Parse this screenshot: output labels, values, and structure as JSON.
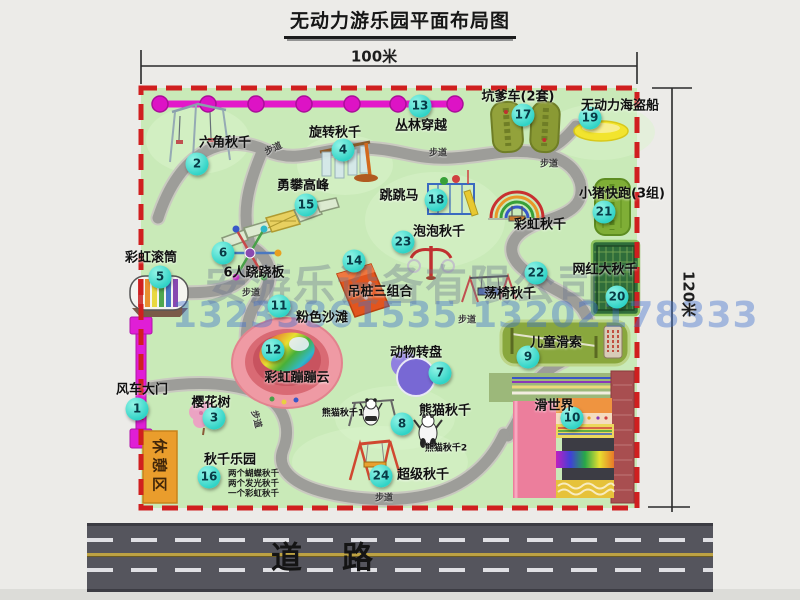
{
  "title": "无动力游乐园平面布局图",
  "dimensions": {
    "top": "100米",
    "right": "120米"
  },
  "watermark": {
    "company": "安游乐设备有限公司",
    "phone": "13233861535 13202178333"
  },
  "road_label": "道路",
  "path_label": "步道",
  "rest_area_label": "休憩区",
  "rainbow_swing_label": "彩虹秋千",
  "panda_swing_1": "熊猫秋千1",
  "panda_swing_2": "熊猫秋千2",
  "items": {
    "1": {
      "num": "1",
      "label": "风车大门"
    },
    "2": {
      "num": "2",
      "label": "六角秋千"
    },
    "3": {
      "num": "3",
      "label": "樱花树"
    },
    "4": {
      "num": "4",
      "label": "旋转秋千"
    },
    "5": {
      "num": "5",
      "label": "彩虹滚筒"
    },
    "6": {
      "num": "6",
      "label": "6人跷跷板"
    },
    "7": {
      "num": "7",
      "label": "动物转盘"
    },
    "8": {
      "num": "8",
      "label": "熊猫秋千"
    },
    "9": {
      "num": "9",
      "label": "儿童滑索"
    },
    "10": {
      "num": "10",
      "label": "滑世界"
    },
    "11": {
      "num": "11",
      "label": "粉色沙滩"
    },
    "12": {
      "num": "12",
      "label": "彩虹蹦蹦云"
    },
    "13": {
      "num": "13",
      "label": "丛林穿越"
    },
    "14": {
      "num": "14",
      "label": "吊桩三组合"
    },
    "15": {
      "num": "15",
      "label": "勇攀高峰"
    },
    "16": {
      "num": "16",
      "label": "秋千乐园",
      "notes": [
        "两个蝴蝶秋千",
        "两个发光秋千",
        "一个彩虹秋千"
      ]
    },
    "17": {
      "num": "17",
      "label": "坑爹车(2套)"
    },
    "18": {
      "num": "18",
      "label": "跳跳马"
    },
    "19": {
      "num": "19",
      "label": "无动力海盗船"
    },
    "20": {
      "num": "20",
      "label": "网红大秋千"
    },
    "21": {
      "num": "21",
      "label": "小猪快跑(3组)"
    },
    "22": {
      "num": "22",
      "label": "荡椅秋千"
    },
    "23": {
      "num": "23",
      "label": "泡泡秋千"
    },
    "24": {
      "num": "24",
      "label": "超级秋千"
    }
  },
  "colors": {
    "map_green": "#c9eab8",
    "border_red": "#d01f1f",
    "badge_teal": "#2fd3c6",
    "zipline_magenta": "#e318ca",
    "road_gray": "#55555d"
  }
}
